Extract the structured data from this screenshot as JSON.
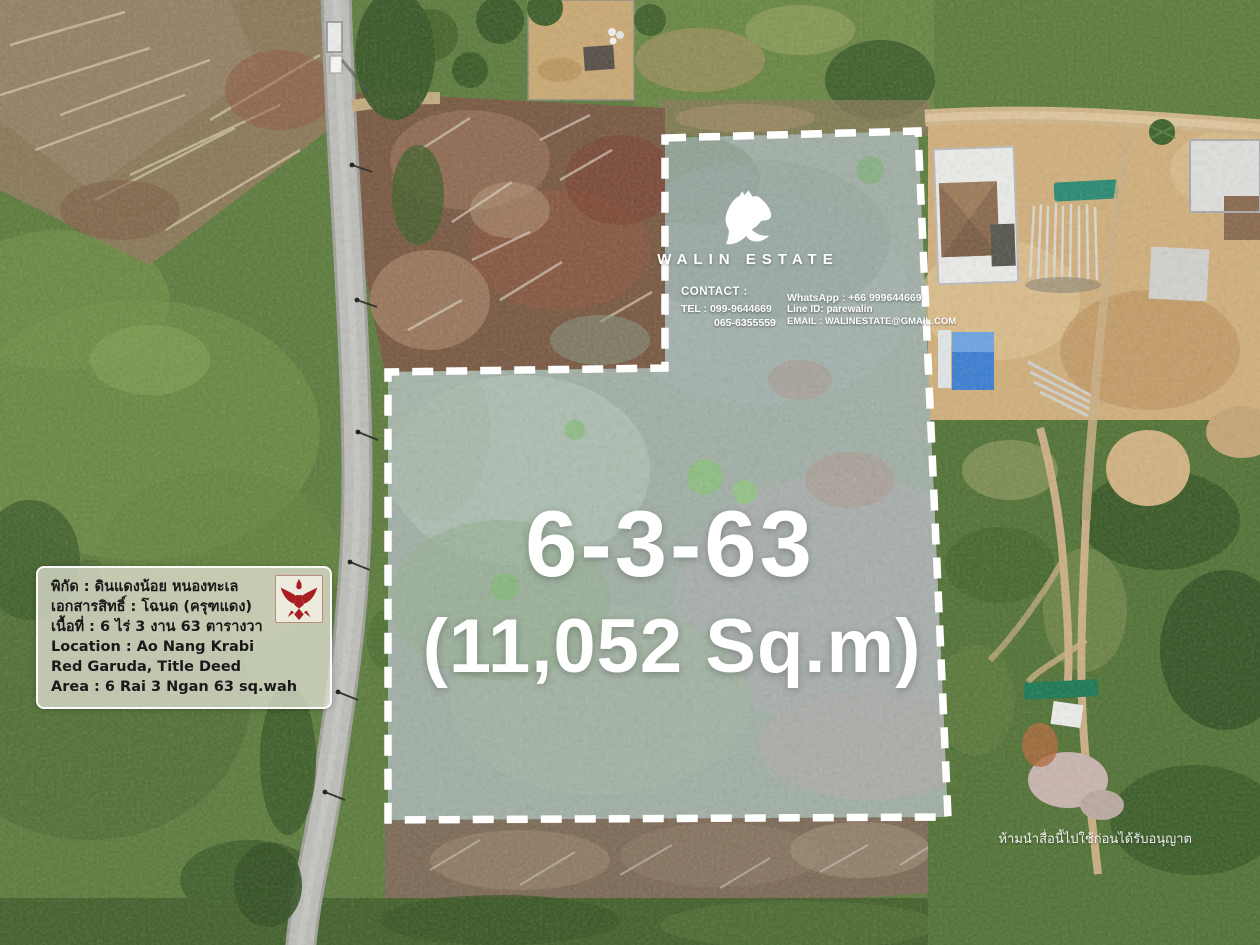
{
  "brand": {
    "name": "WALIN ESTATE",
    "logo_icon": "horse-head-icon",
    "text_color": "#ffffff"
  },
  "contact": {
    "label": "CONTACT :",
    "tel_line1": "TEL : 099-9644669",
    "tel_line2": "065-6355559",
    "whatsapp": "WhatsApp : +66 999644669",
    "line_id": "Line ID: parewalin",
    "email": "EMAIL : WALINESTATE@GMAIL.COM"
  },
  "plot": {
    "area_code": "6-3-63",
    "area_sqm": "(11,052 Sq.m)",
    "outline_color": "#ffffff",
    "fill_tint": "rgba(205,216,232,0.34)"
  },
  "info_box": {
    "line1": "พิกัด : ดินแดงน้อย หนองทะเล",
    "line2": "เอกสารสิทธิ์ : โฉนด (ครุฑแดง)",
    "line3": "เนื้อที่ : 6 ไร่ 3 งาน 63 ตารางวา",
    "line4": "Location : Ao Nang Krabi",
    "line5": "Red Garuda, Title Deed",
    "line6": "Area : 6 Rai 3 Ngan 63 sq.wah",
    "emblem_icon": "red-garuda-emblem",
    "emblem_color": "#a81e22"
  },
  "watermark": {
    "text": "ห้ามนำสื่อนี้ไปใช้ก่อนได้รับอนุญาต"
  }
}
